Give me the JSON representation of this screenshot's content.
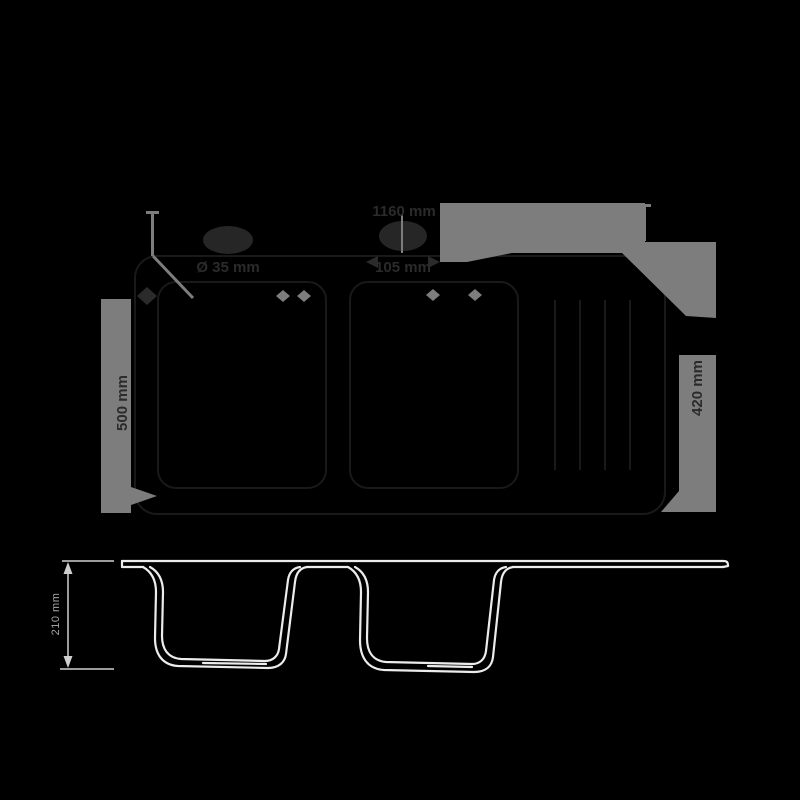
{
  "drawing": {
    "type": "sink-technical-drawing",
    "views": [
      "plan-view-top",
      "section-view-bottom"
    ],
    "colors": {
      "background": "#000000",
      "section_line": "#ececec",
      "dimension_gray": "#7d7d7d",
      "faint_label": "#2b2b2b",
      "dim_text": "#a6a6a6"
    }
  },
  "plan_view": {
    "labels": {
      "overall_width": "1160 mm",
      "center_dim": "105 mm",
      "tap_hole": "Ø 35 mm",
      "depth_left": "500 mm",
      "depth_right": "420 mm"
    }
  },
  "side_view": {
    "depth_label": "210 mm"
  }
}
